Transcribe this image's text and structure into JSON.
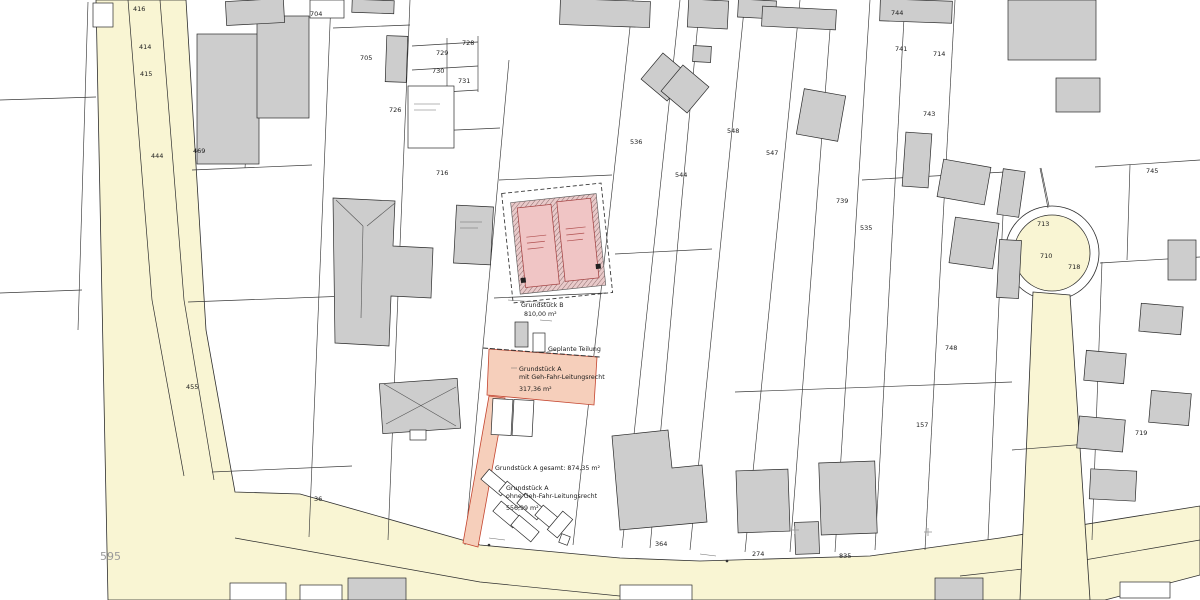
{
  "colors": {
    "road_fill": "#f9f5d3",
    "building_fill": "#cdcdcd",
    "highlight_parcel_fill": "#f6cfbb",
    "highlight_parcel_stroke": "#c4452f",
    "planned_building_fill": "#f0c5c5",
    "planned_building_stroke": "#a03c3c"
  },
  "parcel_labels": [
    {
      "text": "416",
      "x": 133,
      "y": 11
    },
    {
      "text": "414",
      "x": 139,
      "y": 49
    },
    {
      "text": "415",
      "x": 140,
      "y": 76
    },
    {
      "text": "444",
      "x": 151,
      "y": 158
    },
    {
      "text": "595",
      "x": 100,
      "y": 560,
      "size": 11,
      "color": "#9a9a9a"
    },
    {
      "text": "469",
      "x": 193,
      "y": 153
    },
    {
      "text": "455",
      "x": 186,
      "y": 389
    },
    {
      "text": "704",
      "x": 310,
      "y": 16
    },
    {
      "text": "705",
      "x": 360,
      "y": 60
    },
    {
      "text": "728",
      "x": 462,
      "y": 45
    },
    {
      "text": "729",
      "x": 436,
      "y": 55
    },
    {
      "text": "730",
      "x": 432,
      "y": 73
    },
    {
      "text": "731",
      "x": 458,
      "y": 83
    },
    {
      "text": "726",
      "x": 389,
      "y": 112
    },
    {
      "text": "716",
      "x": 436,
      "y": 175
    },
    {
      "text": "536",
      "x": 630,
      "y": 144
    },
    {
      "text": "544",
      "x": 675,
      "y": 177
    },
    {
      "text": "548",
      "x": 727,
      "y": 133
    },
    {
      "text": "547",
      "x": 766,
      "y": 155
    },
    {
      "text": "744",
      "x": 891,
      "y": 15
    },
    {
      "text": "741",
      "x": 895,
      "y": 51
    },
    {
      "text": "714",
      "x": 933,
      "y": 56
    },
    {
      "text": "743",
      "x": 923,
      "y": 116
    },
    {
      "text": "739",
      "x": 836,
      "y": 203
    },
    {
      "text": "535",
      "x": 860,
      "y": 230
    },
    {
      "text": "745",
      "x": 1146,
      "y": 173
    },
    {
      "text": "713",
      "x": 1037,
      "y": 226
    },
    {
      "text": "710",
      "x": 1040,
      "y": 258
    },
    {
      "text": "718",
      "x": 1068,
      "y": 269
    },
    {
      "text": "748",
      "x": 945,
      "y": 350
    },
    {
      "text": "157",
      "x": 916,
      "y": 427
    },
    {
      "text": "719",
      "x": 1135,
      "y": 435
    },
    {
      "text": "364",
      "x": 655,
      "y": 546
    },
    {
      "text": "274",
      "x": 752,
      "y": 556
    },
    {
      "text": "835",
      "x": 839,
      "y": 558
    },
    {
      "text": "36",
      "x": 314,
      "y": 501
    }
  ],
  "annotations": {
    "parcel_b": {
      "title": "Grundstück B",
      "area": "810,00 m²"
    },
    "division": {
      "label": "Geplante Teilung"
    },
    "parcel_a_with_easement": {
      "title": "Grundstück A",
      "subtitle": "mit Geh-Fahr-Leitungsrecht",
      "area": "317,36 m²"
    },
    "parcel_a_total": {
      "label": "Grundstück A gesamt: 874,35 m²"
    },
    "parcel_a_without_easement": {
      "title": "Grundstück A",
      "subtitle": "ohne Geh-Fahr-Leitungsrecht",
      "area": "556,99 m²"
    }
  }
}
